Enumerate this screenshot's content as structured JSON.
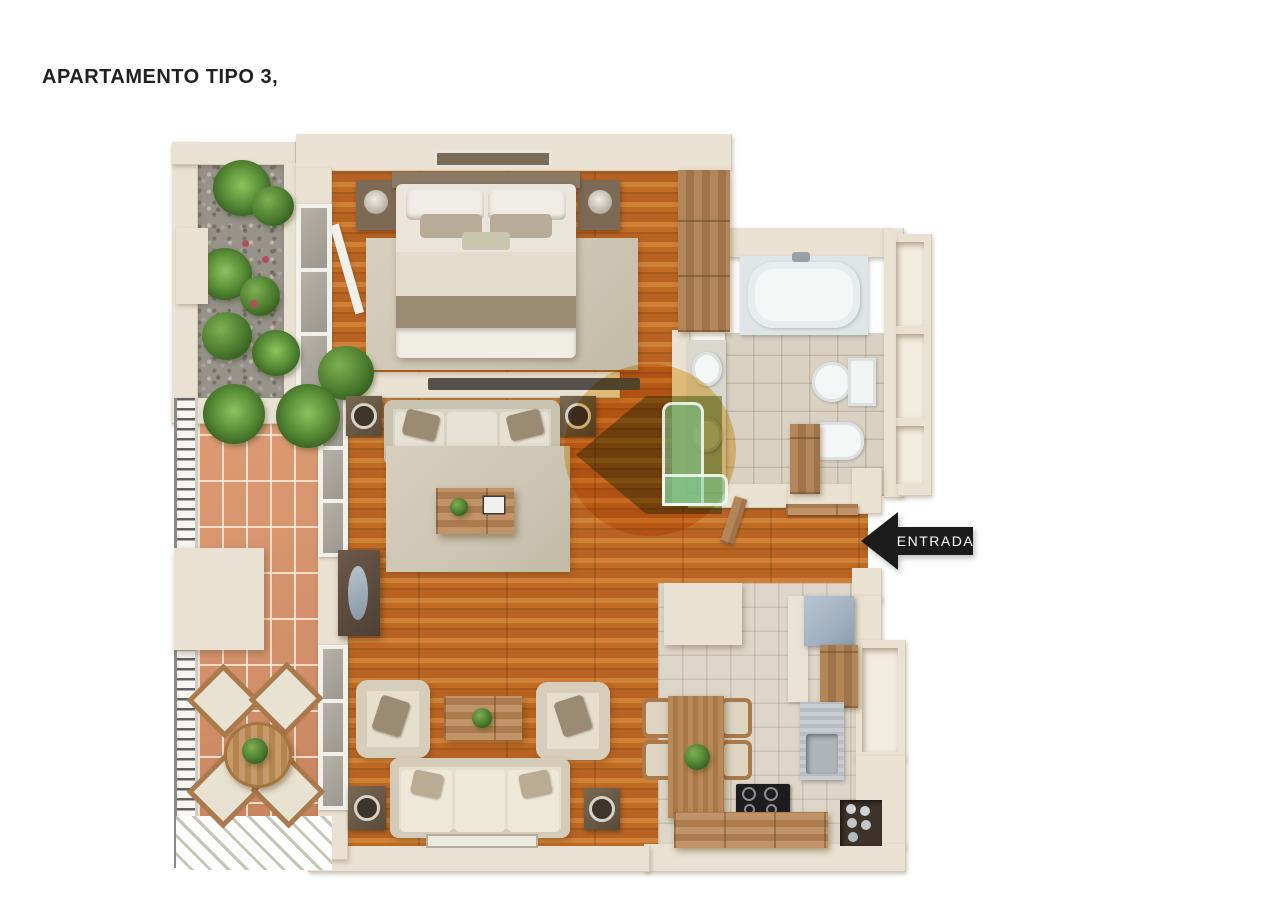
{
  "title": "APARTAMENTO TIPO 3,",
  "entrance": {
    "label": "ENTRADA",
    "arrow_direction": "left"
  },
  "watermark": {
    "icon": "house-logo-watermark",
    "shape": "green-house-in-yellow-circle"
  },
  "colors": {
    "background": "#ffffff",
    "title_text": "#212121",
    "wall": "#e9e1d1",
    "wall_shadow": "#cfc3ae",
    "wood_floor": "#c06a24",
    "wood_floor_dark": "#a85a1c",
    "wood_floor_light": "#d08138",
    "terracotta_floor": "#d2906a",
    "bathroom_tile": "#d9d2c3",
    "kitchen_tile": "#ded7c9",
    "rug": "#cdc6b4",
    "sofa_fabric": "#d9d3c3",
    "armchair_fabric": "#e6dfce",
    "cushion_brown": "#9c8b74",
    "furniture_wood": "#ab7a4c",
    "dark_wood": "#6e5a46",
    "gravel": "#97928a",
    "plant_green": "#4a7a2d",
    "fixture_white": "#f5f6f6",
    "fridge_steel": "#a2b1c1",
    "cooktop_black": "#1d1d1f",
    "entrance_arrow": "#1b1b1b",
    "entrance_text": "#ffffff",
    "railing_metal": "#63625e"
  }
}
